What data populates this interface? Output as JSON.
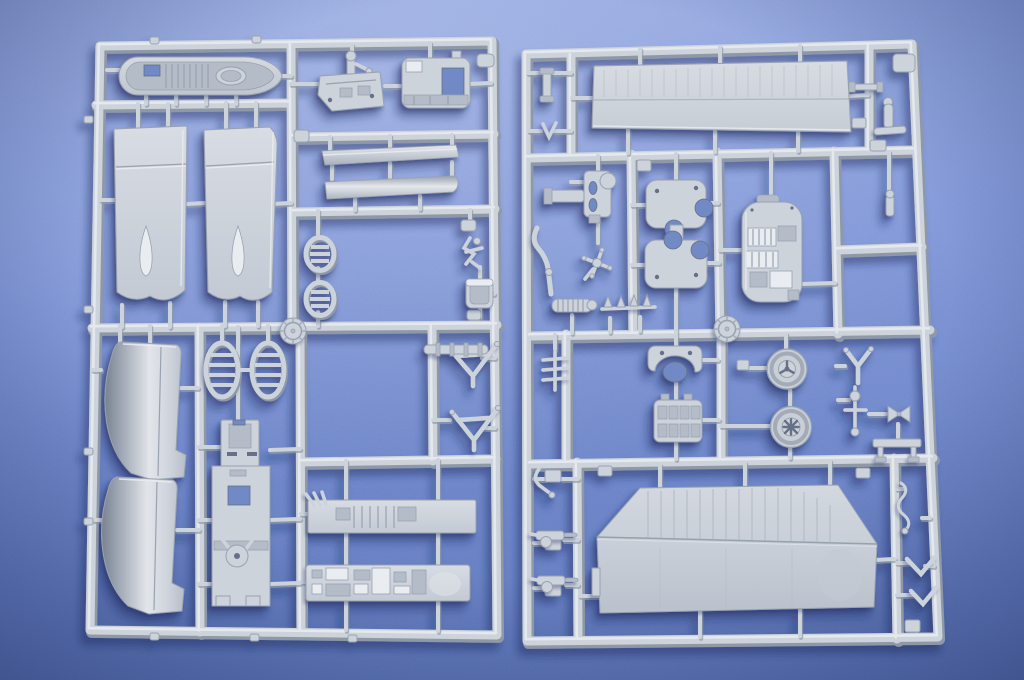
{
  "scene": {
    "subject": "Two light-grey injection-moulded polystyrene sprues (parts frames) of a plastic scale-model aircraft kit photographed on a blue textured paper surface",
    "surface": "blue textured paper with soft vignette",
    "lighting": "soft daylight from the upper right, soft shadows falling to the lower left",
    "sprue_count": 2,
    "plastic_color_name": "light grey"
  },
  "colors": {
    "bg-top": "#8ca2e0",
    "bg-bottom": "#5e78bd",
    "plastic": "#cdd3db",
    "plastic-light": "#e9ecf0",
    "plastic-mid": "#b4bcc7",
    "plastic-dark": "#8f98a7",
    "plastic-deep": "#667086",
    "line": "#99a2b0",
    "hole": "#7189c4",
    "shadow": "#16265a"
  },
  "sprues": {
    "left": {
      "id": "sprue-A",
      "parts": [
        "cockpit-floor-tub",
        "rudder-pedal-bulkhead",
        "cockpit-deck-hatch",
        "fuselage-skin-panel-1",
        "fuselage-skin-panel-2",
        "leading-edge-strip",
        "rolled-skin-strip",
        "radiator-shutter-small-1",
        "radiator-shutter-small-2",
        "mould-stamp-disc",
        "control-column-cluster",
        "bucket-seat",
        "engine-cowl-panel-1",
        "engine-cowl-panel-2",
        "radiator-shutter-large-1",
        "radiator-shutter-large-2",
        "gear-bay-floor",
        "cockpit-sidewall-shelf",
        "equipment-shelf",
        "cabane-strut-1",
        "cabane-strut-2",
        "jointed-rod"
      ]
    },
    "right": {
      "id": "sprue-B",
      "parts": [
        "upper-wing-skin",
        "exhaust-manifold",
        "control-wheel-spider",
        "curved-pipe",
        "fuselage-former-1",
        "fuselage-former-2",
        "engine-crankcase",
        "small-pin-1",
        "small-pin-2",
        "small-pin-3",
        "tailskid-horseshoe",
        "wheel-cover-1",
        "wheel-cover-2",
        "cylinder-block",
        "y-strut",
        "control-linkage",
        "turnbuckle-pair",
        "seat-bench",
        "pitot-wire",
        "v-strut-1",
        "v-strut-2",
        "grab-handle",
        "machine-gun-1",
        "machine-gun-2",
        "comb-fitting",
        "exhaust-stub-row",
        "ribbed-exhaust",
        "lower-wing-skin",
        "mould-stamp-disc"
      ]
    }
  }
}
